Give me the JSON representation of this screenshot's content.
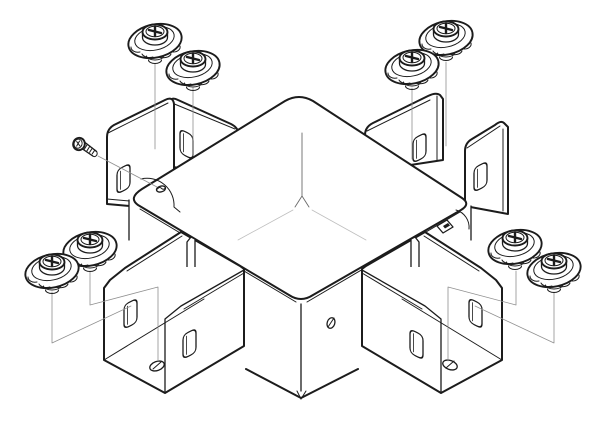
{
  "canvas": {
    "width": 606,
    "height": 432
  },
  "colors": {
    "background": "#ffffff",
    "ink": "#1c1c1c",
    "ink_soft": "#6a6a6a",
    "leader": "#909090",
    "faint": "#bfbfbf"
  },
  "figure": {
    "kind": "exploded-assembly-line-drawing",
    "subject": "square junction cover with four slotted corner plates, two slotted channel sleeves, eight flanged washer screws and one small machine screw",
    "components": [
      {
        "id": "junction-cover-body",
        "label": "square cover body",
        "count": 1
      },
      {
        "id": "bracket-plate",
        "label": "slotted bracket plate",
        "count": 4
      },
      {
        "id": "channel-sleeve",
        "label": "slotted corner channel sleeve",
        "count": 2
      },
      {
        "id": "flanged-screw",
        "label": "flanged washer screw",
        "count": 8
      },
      {
        "id": "machine-screw",
        "label": "small machine screw",
        "count": 1
      }
    ],
    "details": {
      "slots": 8,
      "floor_holes": 2,
      "side_hole": 1,
      "cover_hole": 1,
      "leader_lines": 9
    }
  }
}
